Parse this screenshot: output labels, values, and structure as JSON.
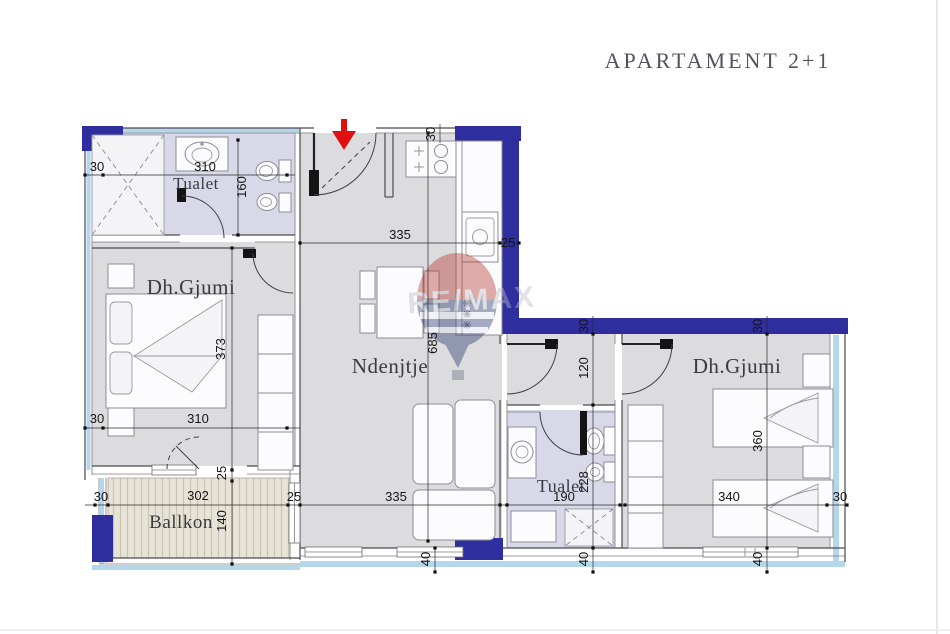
{
  "title": "APARTAMENT 2+1",
  "watermark_text": "RE/MAX",
  "rooms": {
    "tualet_top": "Tualet",
    "bedroom_left": "Dh.Gjumi",
    "living": "Ndenjtje",
    "balcony": "Ballkon",
    "tualet_bottom": "Tualet",
    "bedroom_right": "Dh.Gjumi"
  },
  "dims": {
    "tualet_wall_left": "30",
    "tualet_width": "310",
    "tualet_height": "160",
    "entry_wall": "30",
    "kitchen_width": "335",
    "kitchen_wall": "25",
    "living_height": "685",
    "bedleft_height": "373",
    "bedleft_width": "310",
    "bedleft_wall": "30",
    "balcony_wall_top": "25",
    "balcony_height": "140",
    "balcony_width": "302",
    "balcony_wall_left": "30",
    "balcony_wall_right": "25",
    "living_width": "335",
    "living_wall_bottom": "40",
    "bath_width": "190",
    "bath_height": "228",
    "bath_wall_bottom": "40",
    "hall_height": "120",
    "hall_wall_top": "30",
    "bedright_height": "360",
    "bedright_width": "340",
    "bedright_wall_top": "30",
    "bedright_wall_right": "30",
    "bedright_wall_bottom": "40"
  },
  "colors": {
    "wall_navy": "#2e2e9e",
    "window_blue": "#b5d7ec",
    "floor_gray": "#dcdcde",
    "floor_bath": "#d8d8e8",
    "balcony_floor": "#e7e3d6",
    "arrow_red": "#e01010",
    "line_gray": "#4a4a52",
    "watermark_red": "#b73a31",
    "watermark_blue": "#2c3a6e"
  }
}
